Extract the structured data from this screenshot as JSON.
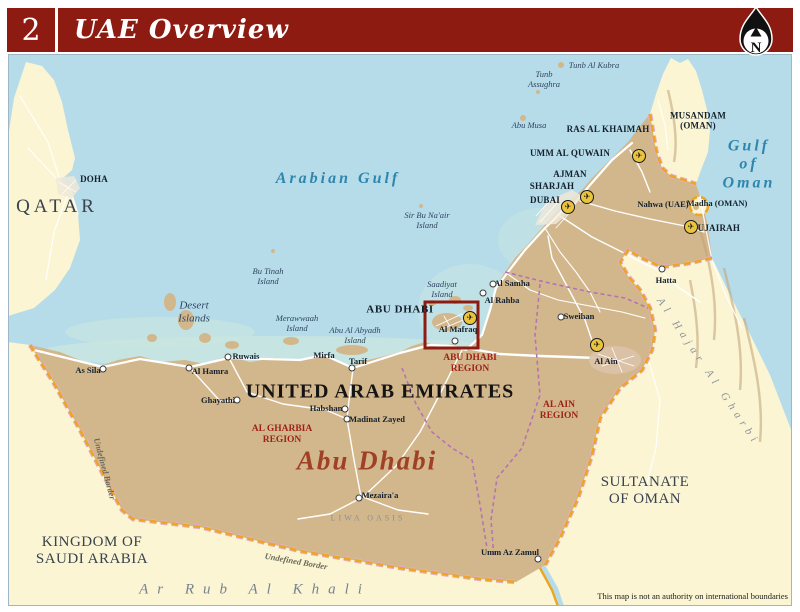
{
  "header": {
    "page_number": "2",
    "title": "UAE Overview",
    "compass_label": "N"
  },
  "colors": {
    "header_red": "#8e1b12",
    "sea": "#b6dcea",
    "land_uae": "#d3b78c",
    "land_neighbor": "#fbf5d3",
    "shallow": "#c9e6e0",
    "road": "#ffffff",
    "border_orange": "#eda522",
    "border_pink": "#e2aec7",
    "region_boundary": "#b473b4",
    "region_label": "#9e2217",
    "city_label": "#14202c",
    "island_label": "#2f4560",
    "sea_label": "#2e86ad",
    "country_label": "#39424e",
    "desert_label": "#76828e",
    "script_red": "#a04127",
    "inset_box_red": "#8e1b12",
    "airport_yellow": "#e9c43c"
  },
  "map": {
    "labels": [
      {
        "id": "arabian-gulf-label",
        "text": "Arabian Gulf",
        "x": 338,
        "y": 179,
        "cls": "sea-lg"
      },
      {
        "id": "gulf-of-oman-label",
        "text": "Gulf of\nOman",
        "x": 749,
        "y": 165,
        "cls": "sea-lg"
      },
      {
        "id": "tunb-al-kubra-island-label",
        "text": "Tunb Al Kubra",
        "x": 594,
        "y": 66,
        "cls": "island"
      },
      {
        "id": "tunb-assughra-island-label",
        "text": "Tunb\nAssughra",
        "x": 544,
        "y": 80,
        "cls": "island"
      },
      {
        "id": "abu-musa-island-label",
        "text": "Abu Musa",
        "x": 529,
        "y": 126,
        "cls": "island"
      },
      {
        "id": "sir-bu-naair-island-label",
        "text": "Sir Bu Na'air\nIsland",
        "x": 427,
        "y": 221,
        "cls": "island"
      },
      {
        "id": "bu-tinah-island-label",
        "text": "Bu Tinah\nIsland",
        "x": 268,
        "y": 277,
        "cls": "island"
      },
      {
        "id": "desert-islands-label",
        "text": "Desert\nIslands",
        "x": 194,
        "y": 312,
        "cls": "island-lg"
      },
      {
        "id": "merawwaah-island-label",
        "text": "Merawwaah\nIsland",
        "x": 297,
        "y": 324,
        "cls": "island"
      },
      {
        "id": "abu-al-abyadh-island-label",
        "text": "Abu Al Abyadh\nIsland",
        "x": 355,
        "y": 336,
        "cls": "island"
      },
      {
        "id": "saadiyat-island-label",
        "text": "Saadiyat\nIsland",
        "x": 442,
        "y": 290,
        "cls": "island"
      },
      {
        "id": "qatar-label",
        "text": "QATAR",
        "x": 57,
        "y": 207,
        "cls": "country-lg"
      },
      {
        "id": "doha-label",
        "text": "DOHA",
        "x": 94,
        "y": 179,
        "cls": "city"
      },
      {
        "id": "saudi-arabia-label",
        "text": "KINGDOM OF\nSAUDI ARABIA",
        "x": 92,
        "y": 551,
        "cls": "country"
      },
      {
        "id": "oman-label",
        "text": "SULTANATE\nOF OMAN",
        "x": 645,
        "y": 491,
        "cls": "country"
      },
      {
        "id": "uae-label",
        "text": "UNITED ARAB EMIRATES",
        "x": 380,
        "y": 392,
        "cls": "uae-name"
      },
      {
        "id": "musandam-label",
        "text": "MUSANDAM\n(OMAN)",
        "x": 698,
        "y": 121,
        "cls": "city"
      },
      {
        "id": "ras-al-khaimah-label",
        "text": "RAS AL KHAIMAH",
        "x": 608,
        "y": 129,
        "cls": "city"
      },
      {
        "id": "umm-al-quwain-label",
        "text": "UMM AL QUWAIN",
        "x": 570,
        "y": 153,
        "cls": "city"
      },
      {
        "id": "ajman-label",
        "text": "AJMAN",
        "x": 570,
        "y": 174,
        "cls": "city"
      },
      {
        "id": "sharjah-label",
        "text": "SHARJAH",
        "x": 552,
        "y": 186,
        "cls": "city"
      },
      {
        "id": "dubai-label",
        "text": "DUBAI",
        "x": 545,
        "y": 200,
        "cls": "city"
      },
      {
        "id": "fujairah-label",
        "text": "FUJAIRAH",
        "x": 716,
        "y": 228,
        "cls": "city"
      },
      {
        "id": "nahwa-uae-label",
        "text": "Nahwa (UAE)",
        "x": 663,
        "y": 205,
        "cls": "town"
      },
      {
        "id": "madha-oman-label",
        "text": "Madha (OMAN)",
        "x": 717,
        "y": 204,
        "cls": "town"
      },
      {
        "id": "hatta-label",
        "text": "Hatta",
        "x": 666,
        "y": 281,
        "cls": "town"
      },
      {
        "id": "abu-dhabi-city-label",
        "text": "ABU DHABI",
        "x": 400,
        "y": 310,
        "cls": "city-lg"
      },
      {
        "id": "al-samha-label",
        "text": "Al Samha",
        "x": 512,
        "y": 284,
        "cls": "town"
      },
      {
        "id": "al-rahba-label",
        "text": "Al Rahba",
        "x": 502,
        "y": 301,
        "cls": "town"
      },
      {
        "id": "sweihan-label",
        "text": "Sweihan",
        "x": 579,
        "y": 317,
        "cls": "town"
      },
      {
        "id": "al-mafraq-label",
        "text": "Al Mafraq",
        "x": 458,
        "y": 330,
        "cls": "town"
      },
      {
        "id": "al-ain-label",
        "text": "Al Ain",
        "x": 606,
        "y": 362,
        "cls": "town"
      },
      {
        "id": "as-sila-label",
        "text": "As Sila",
        "x": 88,
        "y": 371,
        "cls": "town"
      },
      {
        "id": "al-hamra-label",
        "text": "Al Hamra",
        "x": 210,
        "y": 372,
        "cls": "town"
      },
      {
        "id": "ruwais-label",
        "text": "Ruwais",
        "x": 246,
        "y": 357,
        "cls": "town"
      },
      {
        "id": "mirfa-label",
        "text": "Mirfa",
        "x": 324,
        "y": 356,
        "cls": "town"
      },
      {
        "id": "tarif-label",
        "text": "Tarif",
        "x": 358,
        "y": 362,
        "cls": "town"
      },
      {
        "id": "ghayathi-label",
        "text": "Ghayathi",
        "x": 218,
        "y": 401,
        "cls": "town"
      },
      {
        "id": "habshan-label",
        "text": "Habshan",
        "x": 326,
        "y": 409,
        "cls": "town"
      },
      {
        "id": "madinat-zayed-label",
        "text": "Madinat Zayed",
        "x": 377,
        "y": 420,
        "cls": "town"
      },
      {
        "id": "mezairaa-label",
        "text": "Mezaira'a",
        "x": 380,
        "y": 496,
        "cls": "town"
      },
      {
        "id": "umm-az-zamul-label",
        "text": "Umm Az Zamul",
        "x": 510,
        "y": 553,
        "cls": "town"
      },
      {
        "id": "abu-dhabi-region-label",
        "text": "ABU DHABI\nREGION",
        "x": 470,
        "y": 364,
        "cls": "region"
      },
      {
        "id": "al-ain-region-label",
        "text": "AL AIN\nREGION",
        "x": 559,
        "y": 411,
        "cls": "region"
      },
      {
        "id": "al-gharbia-region-label",
        "text": "AL GHARBIA\nREGION",
        "x": 282,
        "y": 435,
        "cls": "region"
      },
      {
        "id": "abu-dhabi-script-label",
        "text": "Abu Dhabi",
        "x": 367,
        "y": 461,
        "cls": "script"
      },
      {
        "id": "ar-rub-al-khali-label",
        "text": "Ar Rub Al Khali",
        "x": 255,
        "y": 590,
        "cls": "desert-sp"
      },
      {
        "id": "liwa-oasis-label",
        "text": "LIWA OASIS",
        "x": 368,
        "y": 518,
        "cls": "liwa"
      },
      {
        "id": "al-hajar-al-gharbi-label",
        "text": "Al Hajar Al Gharbi",
        "x": 708,
        "y": 372,
        "cls": "hajar",
        "rot": 56
      },
      {
        "id": "undefined-border-west-label",
        "text": "Undefined Border",
        "x": 104,
        "y": 469,
        "cls": "border-lbl",
        "rot": 75
      },
      {
        "id": "undefined-border-south-label",
        "text": "Undefined Border",
        "x": 296,
        "y": 562,
        "cls": "border-lbl",
        "rot": 10
      },
      {
        "id": "map-disclaimer",
        "text": "This map is not an authority on international boundaries",
        "x": 788,
        "y": 597,
        "cls": "disclaimer",
        "align": "right"
      }
    ],
    "town_markers": [
      {
        "id": "hatta",
        "x": 662,
        "y": 269
      },
      {
        "id": "al-samha",
        "x": 493,
        "y": 284
      },
      {
        "id": "al-rahba",
        "x": 483,
        "y": 293
      },
      {
        "id": "sweihan",
        "x": 561,
        "y": 317
      },
      {
        "id": "al-mafraq",
        "x": 455,
        "y": 341
      },
      {
        "id": "as-sila",
        "x": 103,
        "y": 369
      },
      {
        "id": "al-hamra",
        "x": 189,
        "y": 368
      },
      {
        "id": "ruwais",
        "x": 228,
        "y": 357
      },
      {
        "id": "tarif",
        "x": 352,
        "y": 368
      },
      {
        "id": "ghayathi",
        "x": 237,
        "y": 400
      },
      {
        "id": "habshan",
        "x": 345,
        "y": 409
      },
      {
        "id": "madinat-zayed",
        "x": 347,
        "y": 419
      },
      {
        "id": "mezairaa",
        "x": 359,
        "y": 498
      },
      {
        "id": "umm-az-zamul",
        "x": 538,
        "y": 559
      }
    ],
    "airports": [
      {
        "id": "ras-al-khaimah",
        "x": 639,
        "y": 156
      },
      {
        "id": "sharjah",
        "x": 587,
        "y": 197
      },
      {
        "id": "dubai",
        "x": 568,
        "y": 207
      },
      {
        "id": "fujairah",
        "x": 691,
        "y": 227
      },
      {
        "id": "abu-dhabi",
        "x": 470,
        "y": 318
      },
      {
        "id": "al-ain",
        "x": 597,
        "y": 345
      }
    ],
    "inset_box": {
      "x": 425,
      "y": 302,
      "w": 53,
      "h": 46
    }
  }
}
